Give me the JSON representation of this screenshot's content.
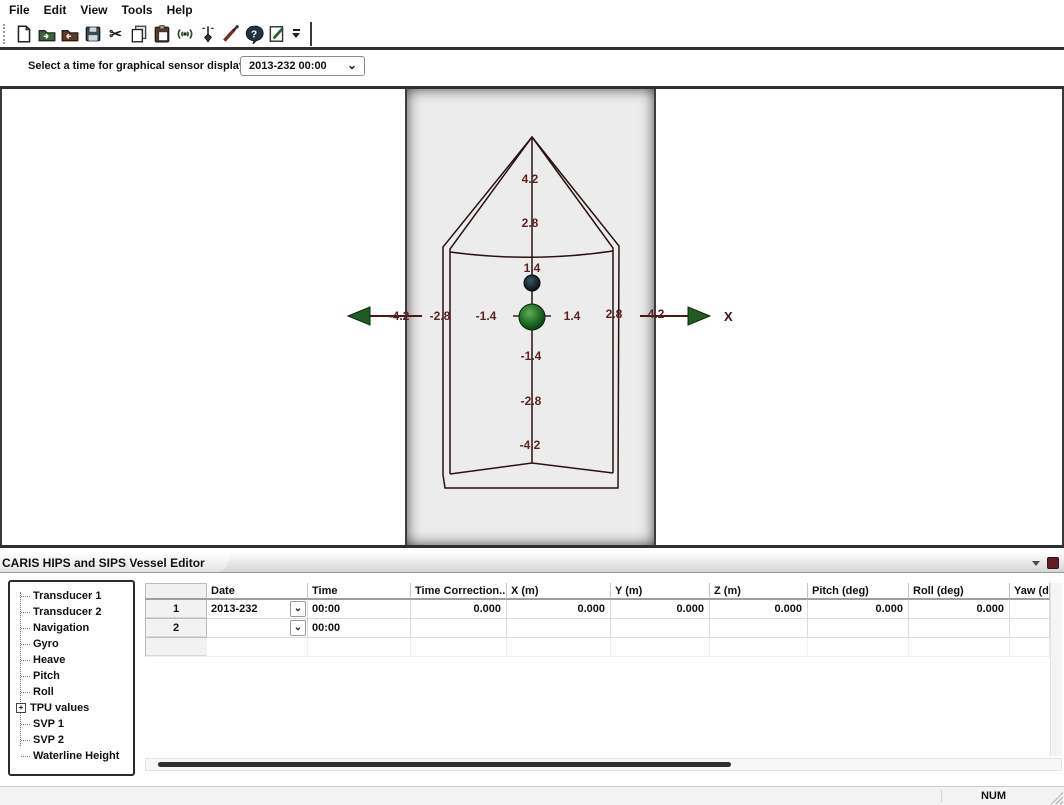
{
  "menu": {
    "items": [
      "File",
      "Edit",
      "View",
      "Tools",
      "Help"
    ]
  },
  "toolbar": {
    "icons": [
      "new-document-icon",
      "open-project-icon",
      "import-folder-icon",
      "save-icon",
      "cut-icon",
      "copy-icon",
      "paste-icon",
      "broadcast-icon",
      "plumb-sensor-icon",
      "probe-tool-icon",
      "help-icon",
      "edit-notes-icon",
      "toolbar-overflow-icon"
    ]
  },
  "time_selector": {
    "label": "Select a time for graphical sensor display:",
    "value": "2013-232 00:00"
  },
  "diagram": {
    "x_axis_label": "X",
    "x_ticks": {
      "n42": "-4.2",
      "n28": "-2.8",
      "n14": "-1.4",
      "p14": "1.4",
      "p28": "2.8",
      "p42": "4.2"
    },
    "y_ticks": {
      "p42": "4.2",
      "p28": "2.8",
      "p14": "1.4",
      "n14": "-1.4",
      "n28": "-2.8",
      "n42": "-4.2"
    },
    "markers": [
      "origin-sphere-green",
      "sensor-sphere-dark"
    ],
    "colors": {
      "hull_line": "#2a1212",
      "axis_text": "#5e2222",
      "arrow_head": "#1e5c22",
      "origin_sphere": "#2e7d32",
      "panel_gray": "#ececec"
    }
  },
  "panel": {
    "title": "CARIS HIPS and SIPS Vessel Editor"
  },
  "tree": {
    "items": [
      "Transducer 1",
      "Transducer 2",
      "Navigation",
      "Gyro",
      "Heave",
      "Pitch",
      "Roll",
      "TPU values",
      "SVP 1",
      "SVP 2",
      "Waterline Height"
    ]
  },
  "table": {
    "columns": [
      "",
      "Date",
      "Time",
      "Time Correction...",
      "X (m)",
      "Y (m)",
      "Z (m)",
      "Pitch (deg)",
      "Roll (deg)",
      "Yaw (deg"
    ],
    "rows": [
      {
        "num": "1",
        "date": "2013-232",
        "time": "00:00",
        "time_correction": "0.000",
        "x": "0.000",
        "y": "0.000",
        "z": "0.000",
        "pitch": "0.000",
        "roll": "0.000",
        "yaw": ""
      },
      {
        "num": "2",
        "date": "",
        "time": "00:00",
        "time_correction": "",
        "x": "",
        "y": "",
        "z": "",
        "pitch": "",
        "roll": "",
        "yaw": ""
      }
    ],
    "dropdown_glyph": "⌄"
  },
  "combo_glyph": "⌄",
  "status_bar": {
    "num_indicator": "NUM"
  }
}
